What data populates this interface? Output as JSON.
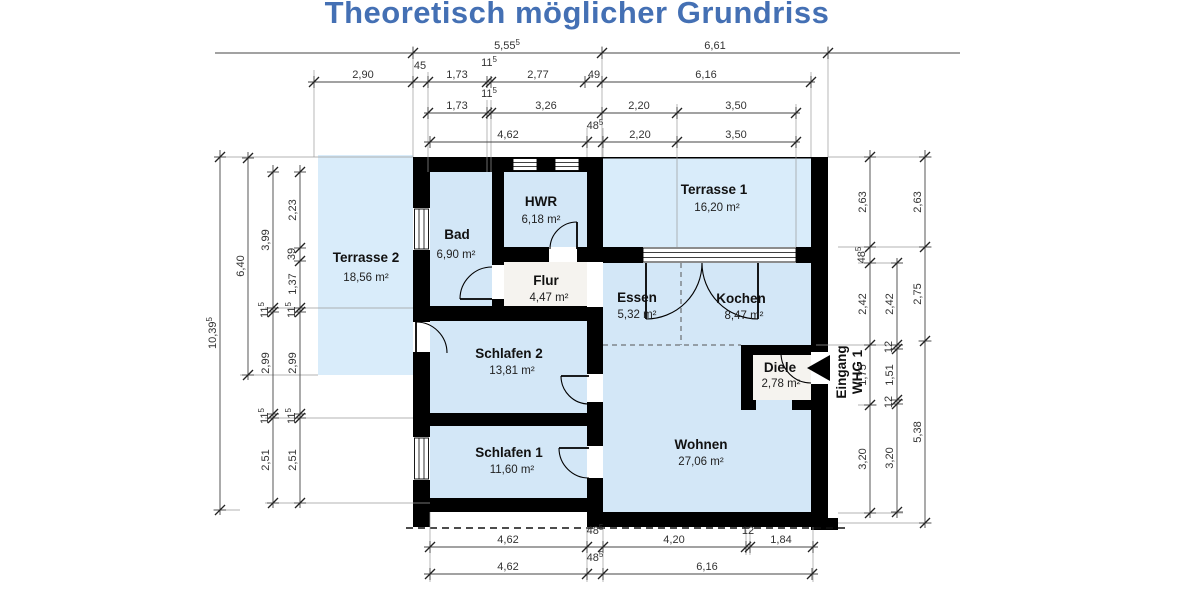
{
  "title": {
    "text": "Theoretisch möglicher Grundriss",
    "color": "#4470b4"
  },
  "colors": {
    "wall": "#000000",
    "room_fill": "#d3e7f7",
    "terrace_fill": "#d9ecfa",
    "hall_fill": "#f5f3ef",
    "dimension_text": "#333333",
    "title_blue": "#4470b4"
  },
  "entrance": {
    "line1": "Eingang",
    "line2": "WHG 1"
  },
  "rooms": [
    {
      "id": "terrasse2",
      "name": "Terrasse 2",
      "area": "18,56 m²"
    },
    {
      "id": "bad",
      "name": "Bad",
      "area": "6,90 m²"
    },
    {
      "id": "hwr",
      "name": "HWR",
      "area": "6,18 m²"
    },
    {
      "id": "terrasse1",
      "name": "Terrasse 1",
      "area": "16,20 m²"
    },
    {
      "id": "flur",
      "name": "Flur",
      "area": "4,47 m²"
    },
    {
      "id": "essen",
      "name": "Essen",
      "area": "5,32 m²"
    },
    {
      "id": "kochen",
      "name": "Kochen",
      "area": "8,47 m²"
    },
    {
      "id": "schlafen2",
      "name": "Schlafen 2",
      "area": "13,81 m²"
    },
    {
      "id": "diele",
      "name": "Diele",
      "area": "2,78 m²"
    },
    {
      "id": "schlafen1",
      "name": "Schlafen 1",
      "area": "11,60 m²"
    },
    {
      "id": "wohnen",
      "name": "Wohnen",
      "area": "27,06 m²"
    }
  ],
  "dim_chains": [
    {
      "o": "h",
      "y": 53,
      "from": 215,
      "to": 960,
      "ticks": [
        413,
        602,
        828
      ],
      "labels": [
        {
          "t": "5,55",
          "sup": "5",
          "x": 507,
          "y": 49
        },
        {
          "t": "6,61",
          "x": 715,
          "y": 49
        }
      ]
    },
    {
      "o": "h",
      "y": 82,
      "from": 308,
      "to": 815,
      "ticks": [
        314,
        413,
        428,
        487,
        491,
        585,
        602,
        811
      ],
      "labels": [
        {
          "t": "2,90",
          "x": 363,
          "y": 78
        },
        {
          "t": "45",
          "x": 420,
          "y": 69
        },
        {
          "t": "1,73",
          "x": 457,
          "y": 78
        },
        {
          "t": "11",
          "sup": "5",
          "x": 489,
          "y": 66
        },
        {
          "t": "2,77",
          "x": 538,
          "y": 78
        },
        {
          "t": "49",
          "x": 594,
          "y": 78
        },
        {
          "t": "6,16",
          "x": 706,
          "y": 78
        }
      ]
    },
    {
      "o": "h",
      "y": 113,
      "from": 424,
      "to": 800,
      "ticks": [
        428,
        487,
        491,
        602,
        677,
        796
      ],
      "labels": [
        {
          "t": "1,73",
          "x": 457,
          "y": 109
        },
        {
          "t": "11",
          "sup": "5",
          "x": 489,
          "y": 97
        },
        {
          "t": "3,26",
          "x": 546,
          "y": 109
        },
        {
          "t": "2,20",
          "x": 639,
          "y": 109
        },
        {
          "t": "3,50",
          "x": 736,
          "y": 109
        }
      ]
    },
    {
      "o": "h",
      "y": 142,
      "from": 424,
      "to": 800,
      "ticks": [
        430,
        587,
        603,
        677,
        796
      ],
      "labels": [
        {
          "t": "4,62",
          "x": 508,
          "y": 138
        },
        {
          "t": "48",
          "sup": "5",
          "x": 595,
          "y": 129
        },
        {
          "t": "2,20",
          "x": 640,
          "y": 138
        },
        {
          "t": "3,50",
          "x": 736,
          "y": 138
        }
      ]
    },
    {
      "o": "h",
      "y": 547,
      "from": 424,
      "to": 818,
      "ticks": [
        430,
        587,
        603,
        746,
        750,
        813
      ],
      "labels": [
        {
          "t": "4,62",
          "x": 508,
          "y": 543
        },
        {
          "t": "48",
          "sup": "5",
          "x": 595,
          "y": 534
        },
        {
          "t": "4,20",
          "x": 674,
          "y": 543
        },
        {
          "t": "12",
          "x": 748,
          "y": 534
        },
        {
          "t": "1,84",
          "x": 781,
          "y": 543
        }
      ]
    },
    {
      "o": "h",
      "y": 574,
      "from": 424,
      "to": 818,
      "ticks": [
        430,
        587,
        603,
        812
      ],
      "labels": [
        {
          "t": "4,62",
          "x": 508,
          "y": 570
        },
        {
          "t": "48",
          "sup": "5",
          "x": 595,
          "y": 561
        },
        {
          "t": "6,16",
          "x": 707,
          "y": 570
        }
      ]
    },
    {
      "o": "v",
      "x": 220,
      "from": 150,
      "to": 515,
      "ticks": [
        157,
        510
      ],
      "labels": [
        {
          "t": "10,39",
          "sup": "5",
          "x": 216,
          "y": 333,
          "rot": true
        }
      ]
    },
    {
      "o": "v",
      "x": 248,
      "from": 152,
      "to": 380,
      "ticks": [
        158,
        375
      ],
      "labels": [
        {
          "t": "6,40",
          "x": 244,
          "y": 266,
          "rot": true
        }
      ]
    },
    {
      "o": "v",
      "x": 273,
      "from": 165,
      "to": 508,
      "ticks": [
        172,
        308,
        312,
        414,
        418,
        503
      ],
      "labels": [
        {
          "t": "3,99",
          "x": 269,
          "y": 240,
          "rot": true
        },
        {
          "t": "11",
          "sup": "5",
          "x": 268,
          "y": 310,
          "rot": true
        },
        {
          "t": "2,99",
          "x": 269,
          "y": 363,
          "rot": true
        },
        {
          "t": "11",
          "sup": "5",
          "x": 268,
          "y": 416,
          "rot": true
        },
        {
          "t": "2,51",
          "x": 269,
          "y": 460,
          "rot": true
        }
      ]
    },
    {
      "o": "v",
      "x": 300,
      "from": 165,
      "to": 508,
      "ticks": [
        172,
        248,
        261,
        308,
        312,
        414,
        418,
        503
      ],
      "labels": [
        {
          "t": "2,23",
          "x": 296,
          "y": 210,
          "rot": true
        },
        {
          "t": "39",
          "x": 295,
          "y": 254,
          "rot": true
        },
        {
          "t": "1,37",
          "x": 296,
          "y": 284,
          "rot": true
        },
        {
          "t": "11",
          "sup": "5",
          "x": 295,
          "y": 310,
          "rot": true
        },
        {
          "t": "2,99",
          "x": 296,
          "y": 363,
          "rot": true
        },
        {
          "t": "11",
          "sup": "5",
          "x": 295,
          "y": 416,
          "rot": true
        },
        {
          "t": "2,51",
          "x": 296,
          "y": 460,
          "rot": true
        }
      ]
    },
    {
      "o": "v",
      "x": 870,
      "from": 150,
      "to": 518,
      "ticks": [
        157,
        247,
        263,
        345,
        405,
        513
      ],
      "labels": [
        {
          "t": "2,63",
          "x": 866,
          "y": 202,
          "rot": true
        },
        {
          "t": "48",
          "sup": "5",
          "x": 865,
          "y": 255,
          "rot": true
        },
        {
          "t": "2,42",
          "x": 866,
          "y": 304,
          "rot": true
        },
        {
          "t": "1,75",
          "x": 866,
          "y": 375,
          "rot": true
        },
        {
          "t": "3,20",
          "x": 866,
          "y": 459,
          "rot": true
        }
      ]
    },
    {
      "o": "v",
      "x": 897,
      "from": 258,
      "to": 518,
      "ticks": [
        263,
        345,
        349,
        400,
        404,
        512
      ],
      "labels": [
        {
          "t": "2,42",
          "x": 893,
          "y": 304,
          "rot": true
        },
        {
          "t": "12",
          "x": 892,
          "y": 347,
          "rot": true
        },
        {
          "t": "1,51",
          "x": 893,
          "y": 375,
          "rot": true
        },
        {
          "t": "12",
          "x": 892,
          "y": 402,
          "rot": true
        },
        {
          "t": "3,20",
          "x": 893,
          "y": 458,
          "rot": true
        }
      ]
    },
    {
      "o": "v",
      "x": 925,
      "from": 150,
      "to": 528,
      "ticks": [
        157,
        247,
        341,
        523
      ],
      "labels": [
        {
          "t": "2,63",
          "x": 921,
          "y": 202,
          "rot": true
        },
        {
          "t": "2,75",
          "x": 921,
          "y": 294,
          "rot": true
        },
        {
          "t": "5,38",
          "x": 921,
          "y": 432,
          "rot": true
        }
      ]
    }
  ]
}
